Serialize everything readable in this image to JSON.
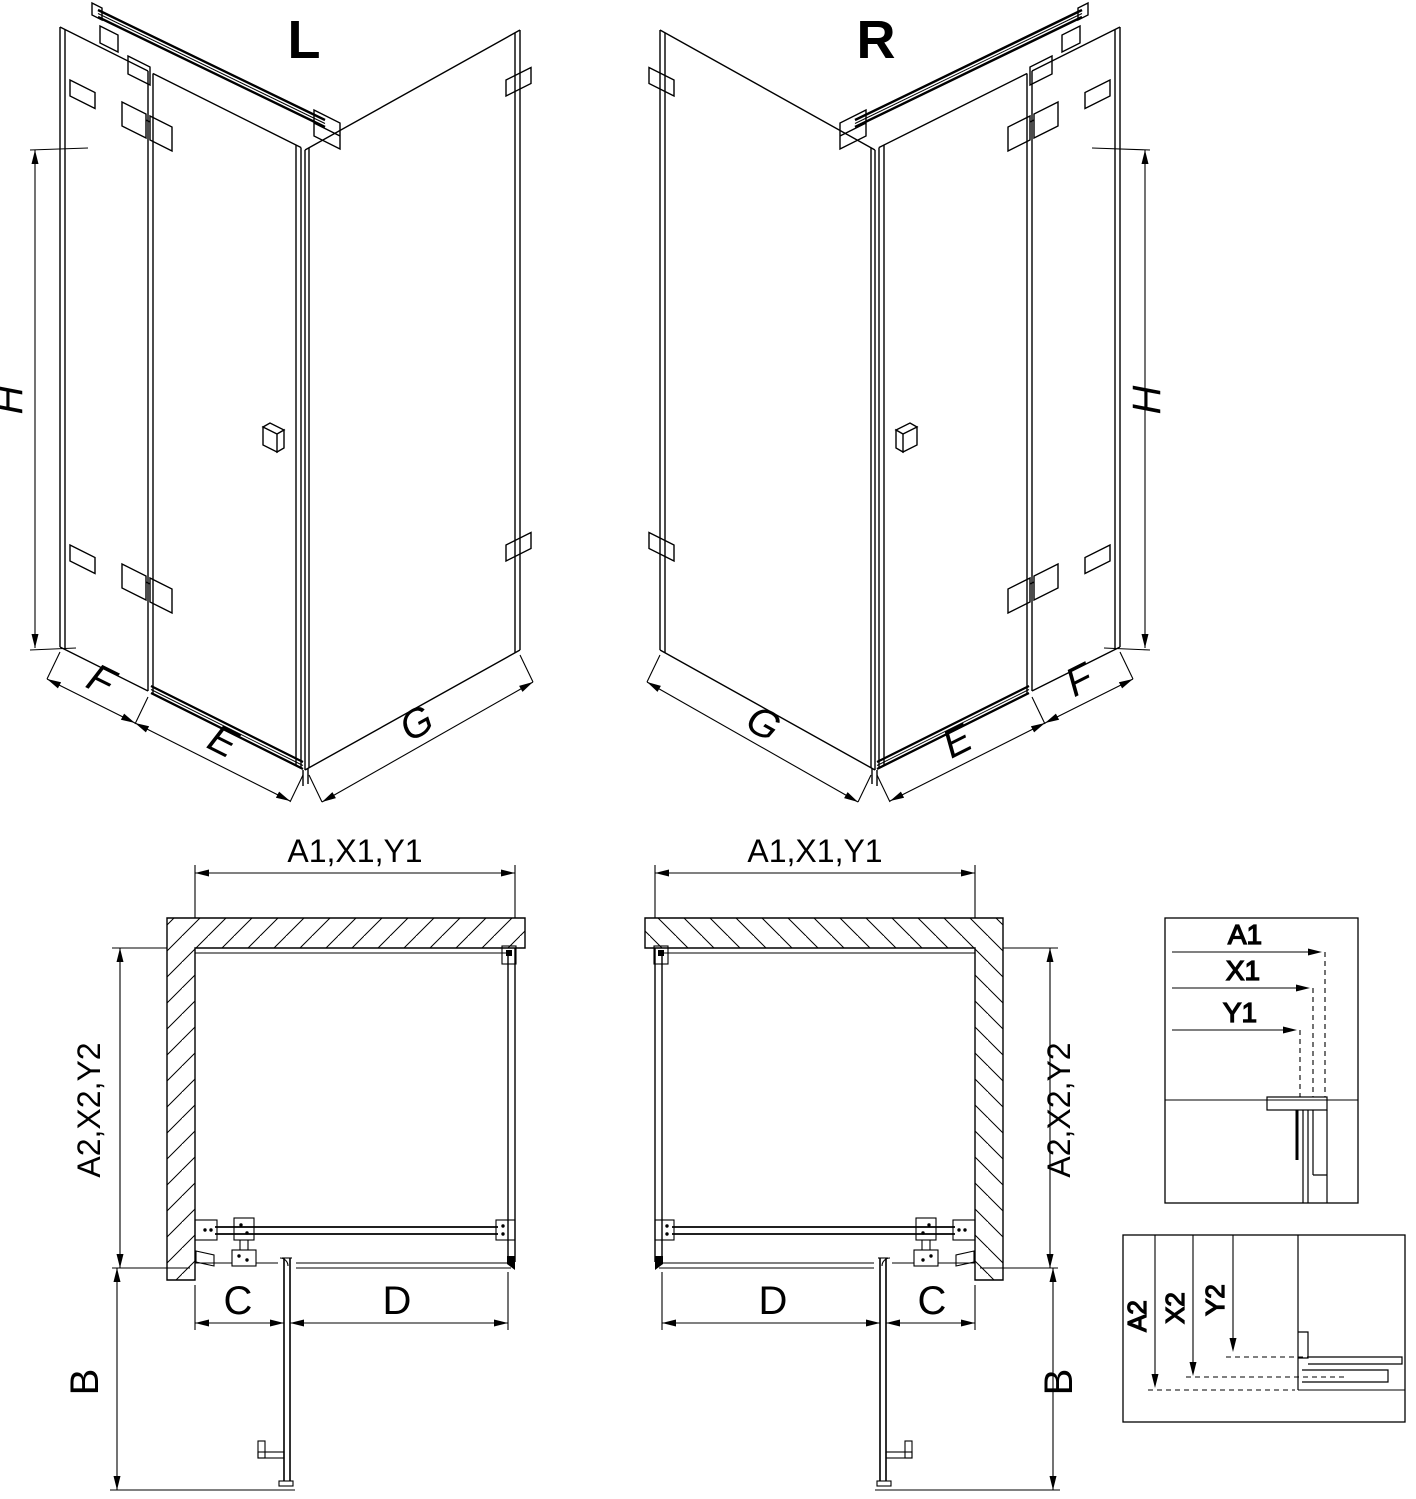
{
  "colors": {
    "background": "#ffffff",
    "line": "#000000"
  },
  "views": {
    "iso_left": {
      "label": "L",
      "dim_height": "H",
      "dim_fixed": "F",
      "dim_door": "E",
      "dim_return": "G"
    },
    "iso_right": {
      "label": "R",
      "dim_height": "H",
      "dim_fixed": "F",
      "dim_door": "E",
      "dim_return": "G"
    },
    "plan_left": {
      "dim_top": "A1,X1,Y1",
      "dim_side": "A2,X2,Y2",
      "dim_c": "C",
      "dim_d": "D",
      "dim_b": "B"
    },
    "plan_right": {
      "dim_top": "A1,X1,Y1",
      "dim_side": "A2,X2,Y2",
      "dim_c": "C",
      "dim_d": "D",
      "dim_b": "B"
    },
    "detail_width": {
      "labels": [
        "A1",
        "X1",
        "Y1"
      ]
    },
    "detail_depth": {
      "labels": [
        "A2",
        "X2",
        "Y2"
      ]
    }
  }
}
